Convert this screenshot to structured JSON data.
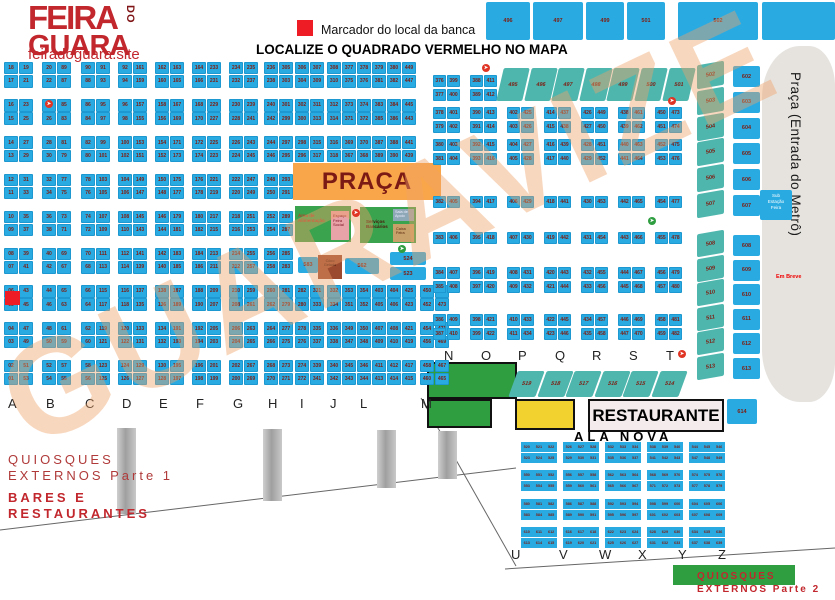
{
  "logo": {
    "line1": "FEIRA",
    "do": "DO",
    "line2": "GUARA",
    "site": "feiradoguara.site"
  },
  "legend": {
    "marker_text": "Marcador do local da banca",
    "marker_color": "#ee1c25"
  },
  "title": "LOCALIZE O QUADRADO VERMELHO NO MAPA",
  "watermark": "GUARAVIZE",
  "icons": {
    "marker": "red-square",
    "direction_red": "red-circle-arrow",
    "direction_green": "green-circle-arrow"
  },
  "main_grid": {
    "letters": [
      "A",
      "B",
      "C",
      "D",
      "E",
      "F",
      "G",
      "H",
      "I",
      "J",
      "L",
      "M"
    ],
    "columns": [
      {
        "rows": [
          "18 19",
          "17 21",
          "16 23",
          "15 25",
          "14 27",
          "13 29",
          "12 31",
          "11 33",
          "10 35",
          "09 37",
          "08 39",
          "07 41",
          "06 43",
          "05 45",
          "04 47",
          "03 49",
          "02 51",
          "01 53"
        ]
      },
      {
        "rows": [
          "20 89",
          "22 87",
          "24 85",
          "26 83",
          "28 81",
          "30 79",
          "32 77",
          "34 75",
          "36 73",
          "38 71",
          "40 69",
          "42 67",
          "44 65",
          "46 63",
          "48 61",
          "50 59",
          "52 57",
          "54 55"
        ]
      },
      {
        "rows": [
          "90 91",
          "88 93",
          "86 95",
          "84 97",
          "82 99",
          "80 101",
          "78 103",
          "76 105",
          "74 107",
          "72 109",
          "70 111",
          "68 113",
          "66 115",
          "64 117",
          "62 119",
          "60 121",
          "58 123",
          "56 125"
        ]
      },
      {
        "rows": [
          "92 161",
          "94 159",
          "96 157",
          "98 155",
          "100 153",
          "102 151",
          "104 149",
          "106 147",
          "108 145",
          "110 143",
          "112 141",
          "114 139",
          "116 137",
          "118 135",
          "120 133",
          "122 131",
          "124 129",
          "126 127"
        ]
      },
      {
        "rows": [
          "162 163",
          "160 165",
          "158 167",
          "156 169",
          "154 171",
          "152 173",
          "150 175",
          "148 177",
          "146 179",
          "144 181",
          "142 183",
          "140 185",
          "138 187",
          "136 189",
          "134 191",
          "132 193",
          "130 195",
          "128 197"
        ]
      },
      {
        "rows": [
          "164 233",
          "166 231",
          "168 229",
          "170 227",
          "172 225",
          "174 223",
          "176 221",
          "178 219",
          "180 217",
          "182 215",
          "184 213",
          "186 211",
          "188 209",
          "190 207",
          "192 205",
          "194 203",
          "196 201",
          "198 199"
        ]
      },
      {
        "rows": [
          "234 235",
          "232 237",
          "230 239",
          "228 241",
          "226 243",
          "224 245",
          "222 247",
          "220 249",
          "218 251",
          "216 253",
          "214 255",
          "212 257",
          "210 259",
          "208 261",
          "206 263",
          "204 265",
          "202 267",
          "200 269"
        ]
      },
      {
        "rows": [
          "236 305",
          "238 303",
          "240 301",
          "242 299",
          "244 297",
          "246 295",
          "248 293",
          "250 291",
          "252 289",
          "254 287",
          "256 285",
          "258 283",
          "260 281",
          "262 279",
          "264 277",
          "266 275",
          "268 273",
          "270 271"
        ]
      },
      {
        "rows": [
          "306 307",
          "304 309",
          "302 311",
          "300 313",
          "298 315",
          "296 317",
          null,
          null,
          null,
          null,
          null,
          null,
          "282 331",
          "280 333",
          "278 335",
          "276 337",
          "274 339",
          "272 341"
        ]
      },
      {
        "rows": [
          "308 377",
          "310 375",
          "312 373",
          "314 371",
          "316 369",
          "318 367",
          null,
          null,
          null,
          null,
          null,
          null,
          "332 353",
          "334 351",
          "336 349",
          "338 347",
          "340 345",
          "342 343"
        ]
      },
      {
        "rows": [
          "378 379",
          "376 381",
          "374 383",
          "372 385",
          "370 387",
          "368 389",
          null,
          null,
          null,
          null,
          null,
          null,
          "354 403",
          "352 405",
          "350 407",
          "348 409",
          "346 411",
          "344 413"
        ]
      },
      {
        "rows": [
          "380 449",
          "382 447",
          "384 445",
          "386 443",
          "388 441",
          "390 439",
          null,
          null,
          null,
          null,
          null,
          null,
          "404 425",
          "406 423",
          "408 421",
          "410 419",
          "412 417",
          "414 415"
        ]
      },
      {
        "rows": [
          null,
          null,
          null,
          null,
          null,
          null,
          null,
          null,
          null,
          null,
          null,
          null,
          "450 475",
          "452 473",
          "454 471",
          "456 469",
          "458 467",
          "460 465"
        ]
      }
    ]
  },
  "sector_nt": {
    "letters": [
      "N",
      "O",
      "P",
      "Q",
      "R",
      "S",
      "T"
    ],
    "columns": [
      {
        "rows": [
          "376 399",
          "377 400",
          "378 401",
          "379 402",
          "380 403",
          "381 404",
          "382 405",
          "383 406",
          "384 407",
          "385 408",
          "386 409",
          "387 410"
        ]
      },
      {
        "rows": [
          "388 411",
          "389 412",
          "390 413",
          "391 414",
          "392 415",
          "393 416",
          "394 417",
          "395 418",
          "396 419",
          "397 420",
          "398 421",
          "399 422"
        ]
      },
      {
        "rows": [
          null,
          null,
          "402 425",
          "403 426",
          "404 427",
          "405 428",
          "406 429",
          "407 430",
          "408 431",
          "409 432",
          "410 433",
          "411 434"
        ]
      },
      {
        "rows": [
          null,
          null,
          "414 437",
          "415 438",
          "416 439",
          "417 440",
          "418 441",
          "419 442",
          "420 443",
          "421 444",
          "422 445",
          "423 446"
        ]
      },
      {
        "rows": [
          null,
          null,
          "426 449",
          "427 450",
          "428 451",
          "429 452",
          "430 453",
          "431 454",
          "432 455",
          "433 456",
          "434 457",
          "435 458"
        ]
      },
      {
        "rows": [
          null,
          null,
          "438 461",
          "439 462",
          "440 463",
          "441 464",
          "442 465",
          "443 466",
          "444 467",
          "445 468",
          "446 469",
          "447 470"
        ]
      },
      {
        "rows": [
          null,
          null,
          "450 473",
          "451 474",
          "452 475",
          "453 476",
          "454 477",
          "455 478",
          "456 479",
          "457 480",
          "458 481",
          "459 482"
        ]
      }
    ]
  },
  "top_strip": {
    "squares": [
      "496",
      "497",
      "499",
      "501"
    ],
    "wide": "502"
  },
  "slant_row_top": [
    "495",
    "496",
    "497",
    "498",
    "499",
    "500",
    "501"
  ],
  "right_columns": {
    "slanted": [
      "502",
      "503",
      "504",
      "505",
      "506",
      "507",
      "508",
      "509",
      "510",
      "511",
      "512",
      "513"
    ],
    "rect": [
      "602",
      "603",
      "604",
      "605",
      "606",
      "607",
      "608",
      "609",
      "610",
      "611",
      "612",
      "613"
    ],
    "extra_box": "614"
  },
  "bottom_slant_row": [
    "519",
    "518",
    "517",
    "516",
    "515",
    "514"
  ],
  "praca": {
    "title": "PRAÇA",
    "green_left_label": "Área de\nAlimentação",
    "pink_label": "Espaço\nFeira\nSocial",
    "green_right_label": "Serviços\nBancários",
    "gray_label": "Sala de\nApoio",
    "tan_label": "Caixa\nFeira",
    "small_blue": "583",
    "brown_box": "Côco\nGelado",
    "wide_blue": "562",
    "stack": [
      "524",
      "523"
    ]
  },
  "ala_nova": {
    "title": "ALA NOVA",
    "letters": [
      "U",
      "V",
      "W",
      "X",
      "Y",
      "Z"
    ],
    "blocks": [
      [
        "520",
        "521",
        "522",
        "523",
        "524",
        "525"
      ],
      [
        "526",
        "527",
        "528",
        "529",
        "530",
        "531"
      ],
      [
        "532",
        "533",
        "534",
        "535",
        "536",
        "537"
      ],
      [
        "538",
        "539",
        "540",
        "541",
        "542",
        "543"
      ],
      [
        "544",
        "545",
        "546",
        "547",
        "548",
        "549"
      ],
      [
        "550",
        "551",
        "552",
        "553",
        "554",
        "555"
      ],
      [
        "556",
        "557",
        "558",
        "559",
        "560",
        "561"
      ],
      [
        "562",
        "563",
        "564",
        "565",
        "566",
        "567"
      ],
      [
        "568",
        "569",
        "570",
        "571",
        "572",
        "573"
      ],
      [
        "574",
        "575",
        "576",
        "577",
        "578",
        "579"
      ],
      [
        "580",
        "581",
        "582",
        "583",
        "584",
        "585"
      ],
      [
        "586",
        "587",
        "588",
        "589",
        "590",
        "591"
      ],
      [
        "592",
        "593",
        "594",
        "595",
        "596",
        "597"
      ],
      [
        "598",
        "599",
        "600",
        "601",
        "602",
        "603"
      ],
      [
        "604",
        "605",
        "606",
        "607",
        "608",
        "609"
      ],
      [
        "610",
        "611",
        "612",
        "613",
        "614",
        "615"
      ],
      [
        "616",
        "617",
        "618",
        "619",
        "620",
        "621"
      ],
      [
        "622",
        "623",
        "624",
        "625",
        "626",
        "627"
      ],
      [
        "628",
        "629",
        "630",
        "631",
        "632",
        "633"
      ],
      [
        "634",
        "635",
        "636",
        "637",
        "638",
        "639"
      ]
    ]
  },
  "labels": {
    "restaurante": "RESTAURANTE",
    "metro": "Praça (Entrada do Metrô)",
    "sub_estacao": "Sub\nEstação\nFeira",
    "em_breve": "Em Breve",
    "quiosques1": "QUIOSQUES\nEXTERNOS Parte 1",
    "bares": "BARES E\nRESTAURANTES",
    "quiosques2": "QUIOSQUES\nEXTERNOS Parte 2"
  }
}
